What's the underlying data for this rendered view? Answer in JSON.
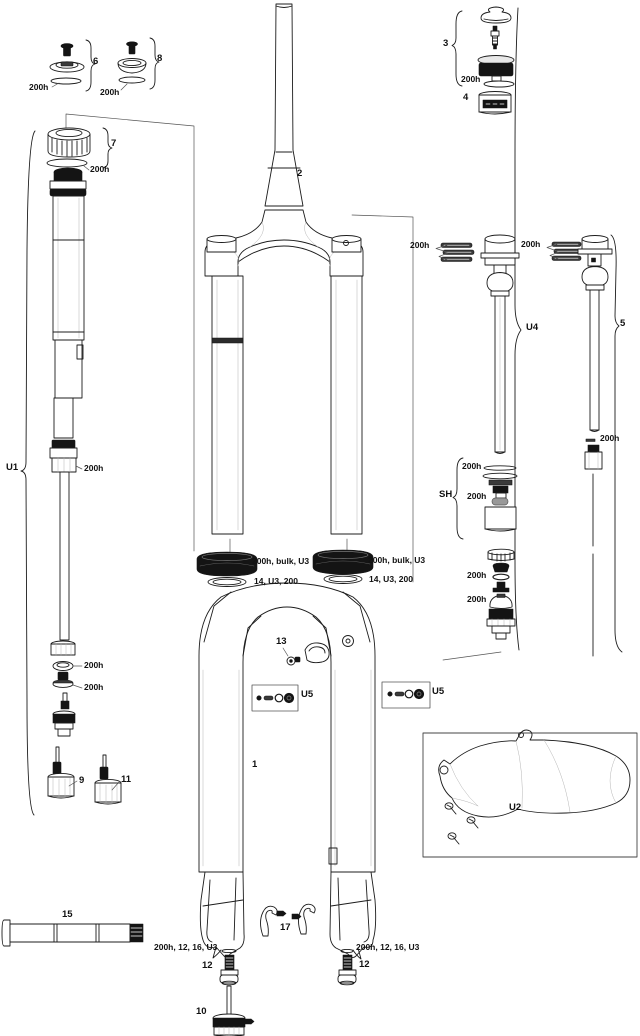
{
  "labels": {
    "item1": "1",
    "item2": "2",
    "item3": "3",
    "item4": "4",
    "item5": "5",
    "item6": "6",
    "item7": "7",
    "item8": "8",
    "item9": "9",
    "item10": "10",
    "item11": "11",
    "item12": "12",
    "item13": "13",
    "item15": "15",
    "item17": "17",
    "u1": "U1",
    "u2": "U2",
    "u4": "U4",
    "u5": "U5",
    "sh": "SH",
    "oring": "200h",
    "dust_seal": "200h, bulk, U3",
    "foam_ring": "14, U3, 200",
    "crush_washer": "200h, 12, 16, U3"
  },
  "colors": {
    "line": "#1c1c1c",
    "background": "#ffffff",
    "black_part": "#141414"
  }
}
